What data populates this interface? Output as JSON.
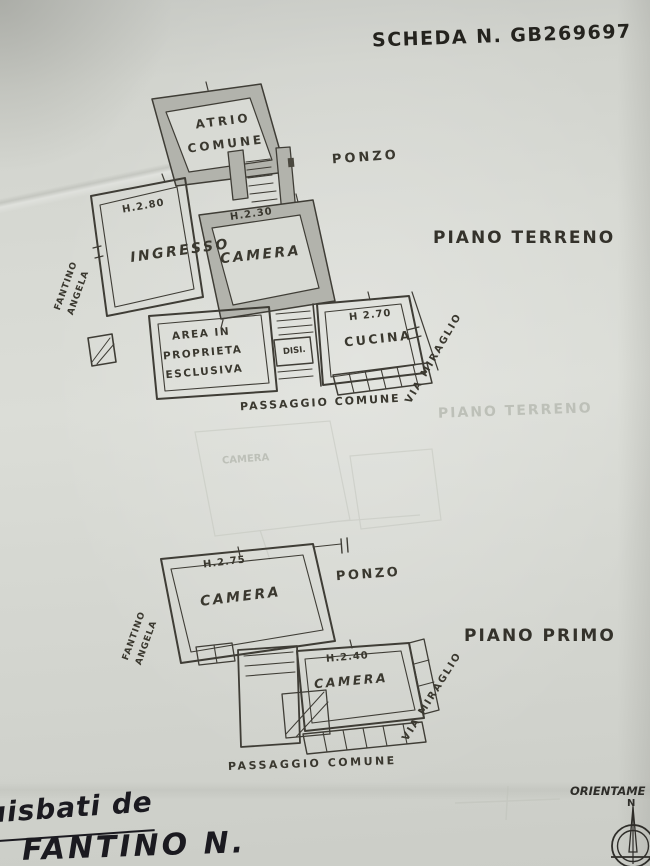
{
  "scheda": {
    "title": "SCHEDA N. GB269697"
  },
  "ground_floor": {
    "label": "PIANO TERRENO",
    "atrio": "ATRIO\nCOMUNE",
    "neighbor": "PONZO",
    "ingresso_height": "H.2.80",
    "ingresso": "INGRESSO",
    "camera_height": "H.2.30",
    "camera": "CAMERA",
    "cucina_height": "H 2.70",
    "cucina": "CUCINA",
    "disimpegno": "DISI.",
    "area_esclusiva": "AREA IN\nPROPRIETA\nESCLUSIVA",
    "passaggio": "PASSAGGIO COMUNE",
    "owner_left": "FANTINO\nANGELA",
    "street": "VIA MIRAGLIO"
  },
  "first_floor": {
    "label": "PIANO PRIMO",
    "camera1_height": "H.2.75",
    "camera1": "CAMERA",
    "neighbor": "PONZO",
    "camera2_height": "H.2.40",
    "camera2": "CAMERA",
    "passaggio": "PASSAGGIO COMUNE",
    "owner_left": "FANTINO\nANGELA",
    "street": "VIA MIRAGLIO"
  },
  "ghost_bleedthrough": {
    "piano_terreno": "PIANO TERRENO",
    "camera": "CAMERA"
  },
  "handwriting": {
    "line1": "uisbati de",
    "line2": "FANTINO N."
  },
  "orientation": {
    "label": "ORIENTAME",
    "north": "N"
  },
  "colors": {
    "paper": "#d6d8d2",
    "ink": "#3b3933",
    "pen": "#1b1a20"
  }
}
